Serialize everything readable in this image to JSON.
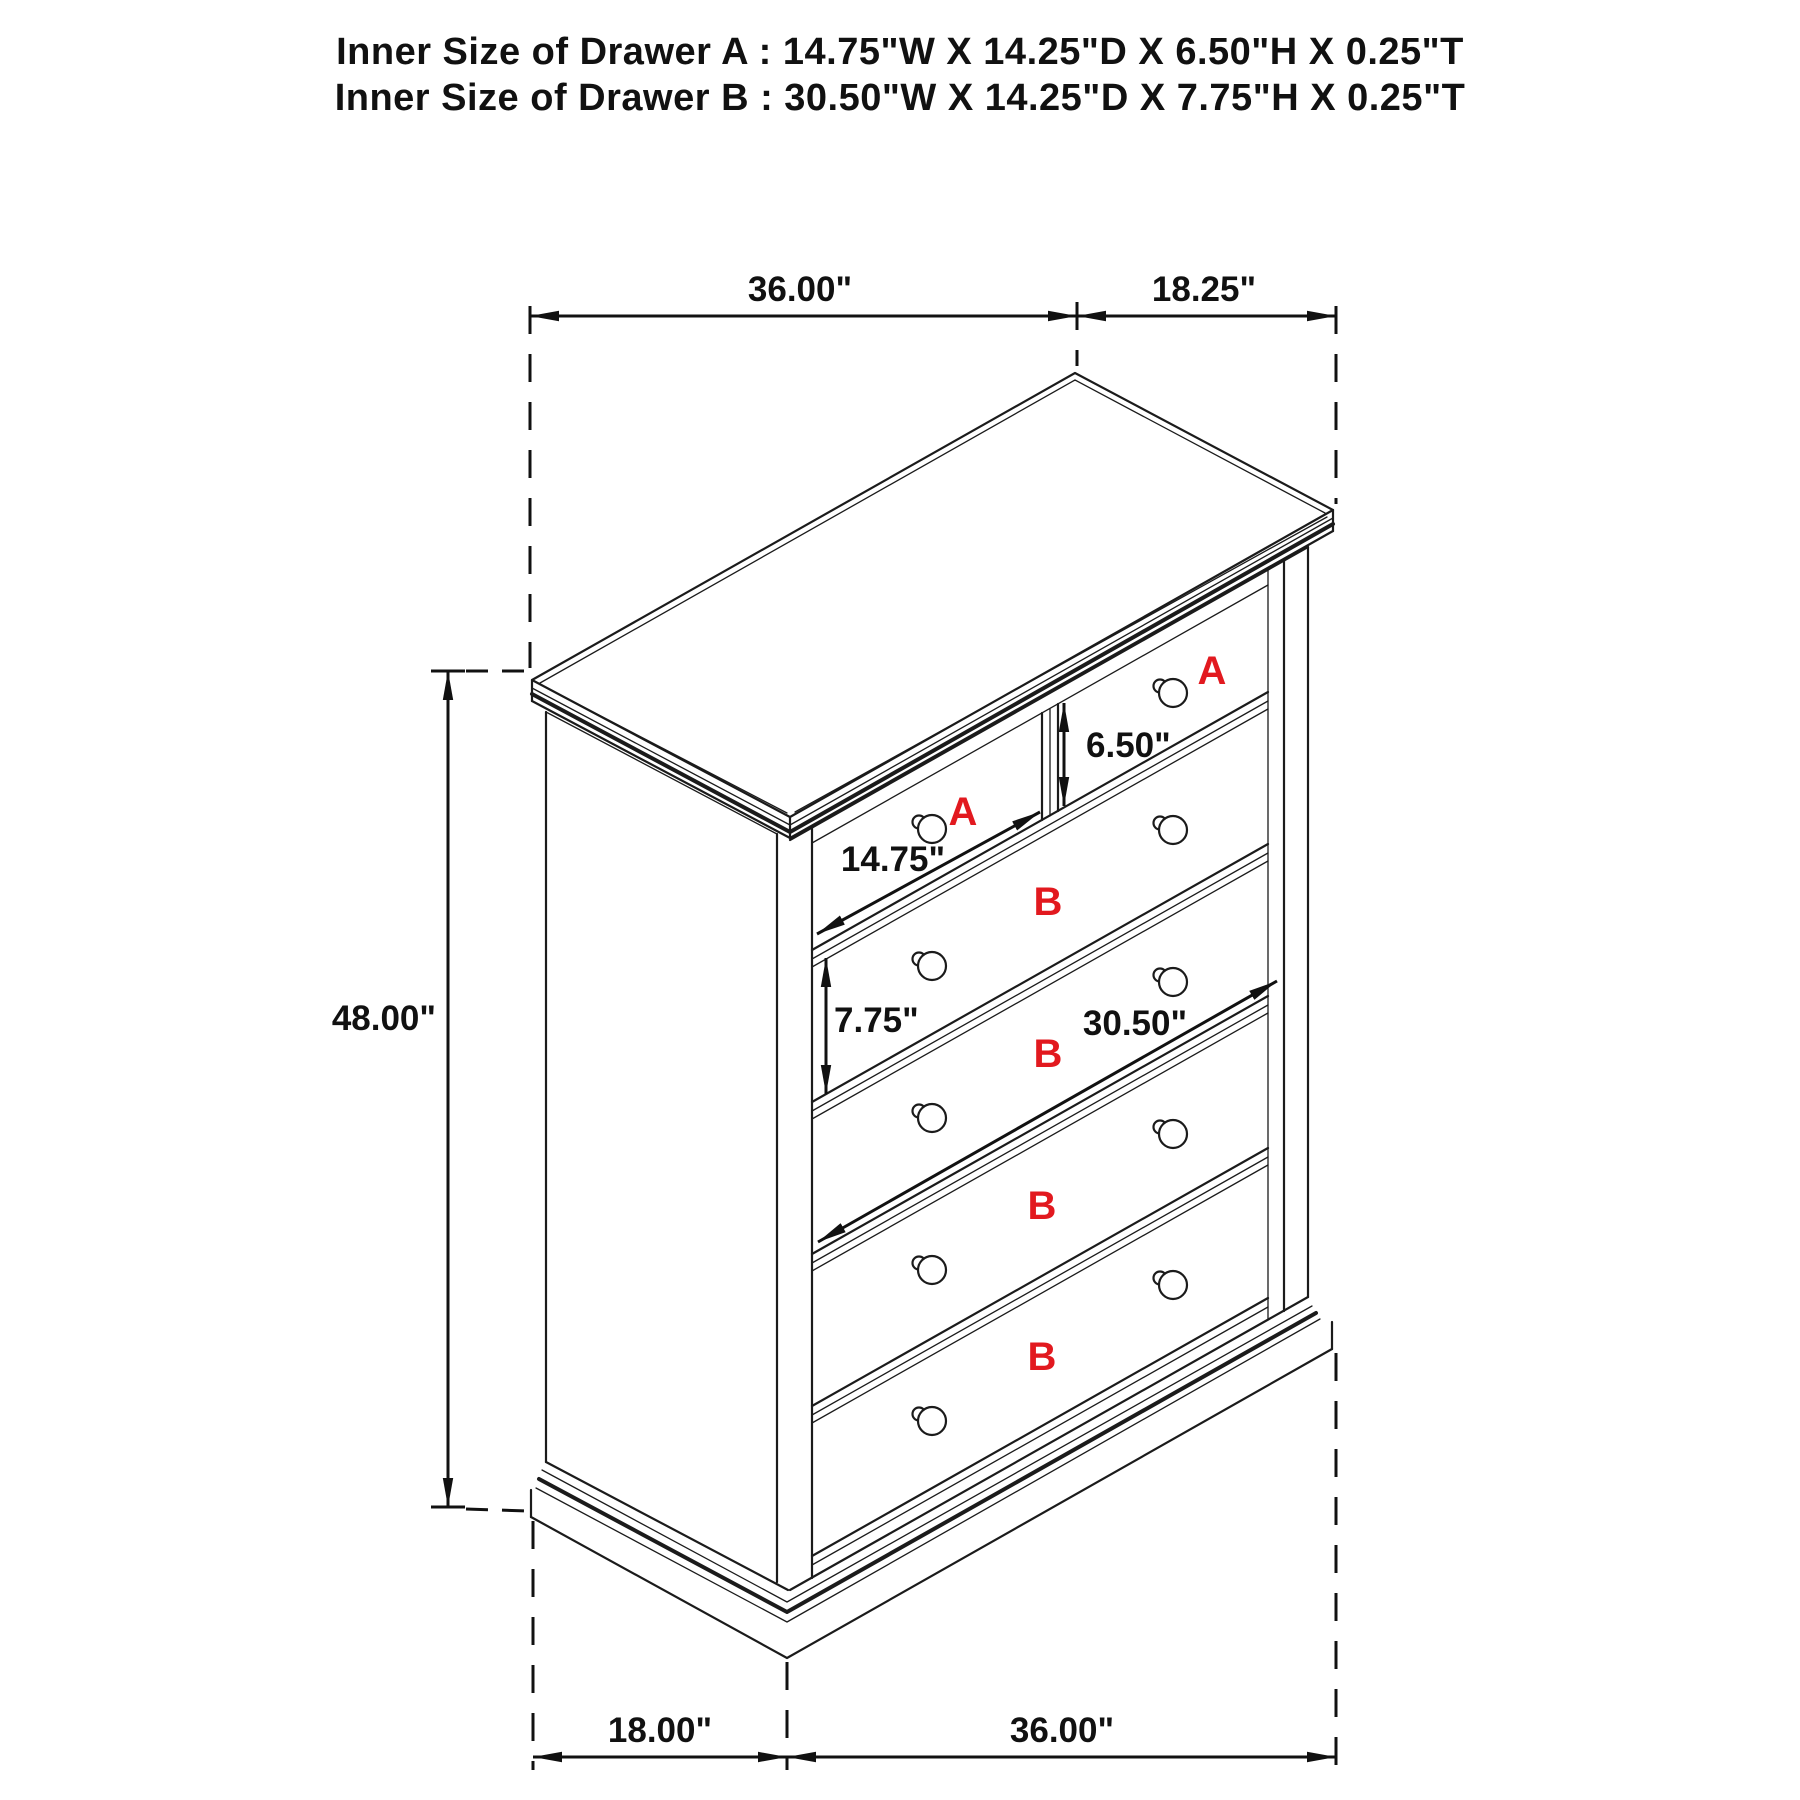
{
  "title": {
    "line1": "Inner Size of Drawer A : 14.75\"W X 14.25\"D X 6.50\"H X 0.25\"T",
    "line2": "Inner Size of Drawer B : 30.50\"W X 14.25\"D X 7.75\"H X 0.25\"T"
  },
  "dimensions": {
    "top_width": "36.00\"",
    "top_depth": "18.25\"",
    "height": "48.00\"",
    "drawer_a_inner_height": "6.50\"",
    "drawer_a_inner_width": "14.75\"",
    "drawer_b_inner_height": "7.75\"",
    "drawer_b_inner_width": "30.50\"",
    "bottom_depth": "18.00\"",
    "bottom_width": "36.00\""
  },
  "drawer_labels": {
    "top_left": "A",
    "top_right": "A",
    "row2": "B",
    "row3": "B",
    "row4": "B",
    "row5": "B"
  },
  "colors": {
    "line": "#1b1b1b",
    "drawer_label_red": "#e2191f",
    "background": "#ffffff"
  }
}
